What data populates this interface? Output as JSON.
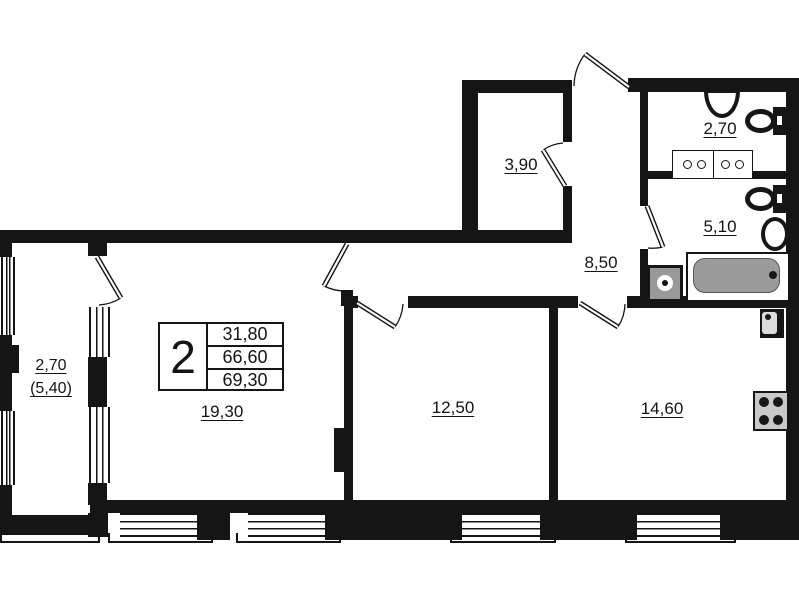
{
  "plan": {
    "type": "apartment floor plan, 2 rooms",
    "legend": {
      "rooms_count": "2",
      "areas": [
        "31,80",
        "66,60",
        "69,30"
      ]
    },
    "rooms": {
      "living": {
        "area_label": "19,30"
      },
      "bedroom": {
        "area_label": "12,50"
      },
      "kitchen": {
        "area_label": "14,60"
      },
      "hallway": {
        "area_label": "8,50"
      },
      "storage": {
        "area_label": "3,90"
      },
      "wc": {
        "area_label": "2,70"
      },
      "bathroom": {
        "area_label": "5,10"
      },
      "balcony": {
        "area_label": "2,70",
        "area_label_coeff": "(5,40)"
      }
    },
    "fixture_icons": [
      "toilet-icon",
      "wash-basin-icon",
      "double-vanity-icon",
      "bathtub-icon",
      "washing-machine-icon",
      "kitchen-sink-icon",
      "stove-icon"
    ],
    "colors": {
      "walls": "#151515",
      "bathtub_fill": "#9b9b9b",
      "appliance_fill": "#999999",
      "background": "#ffffff"
    }
  }
}
